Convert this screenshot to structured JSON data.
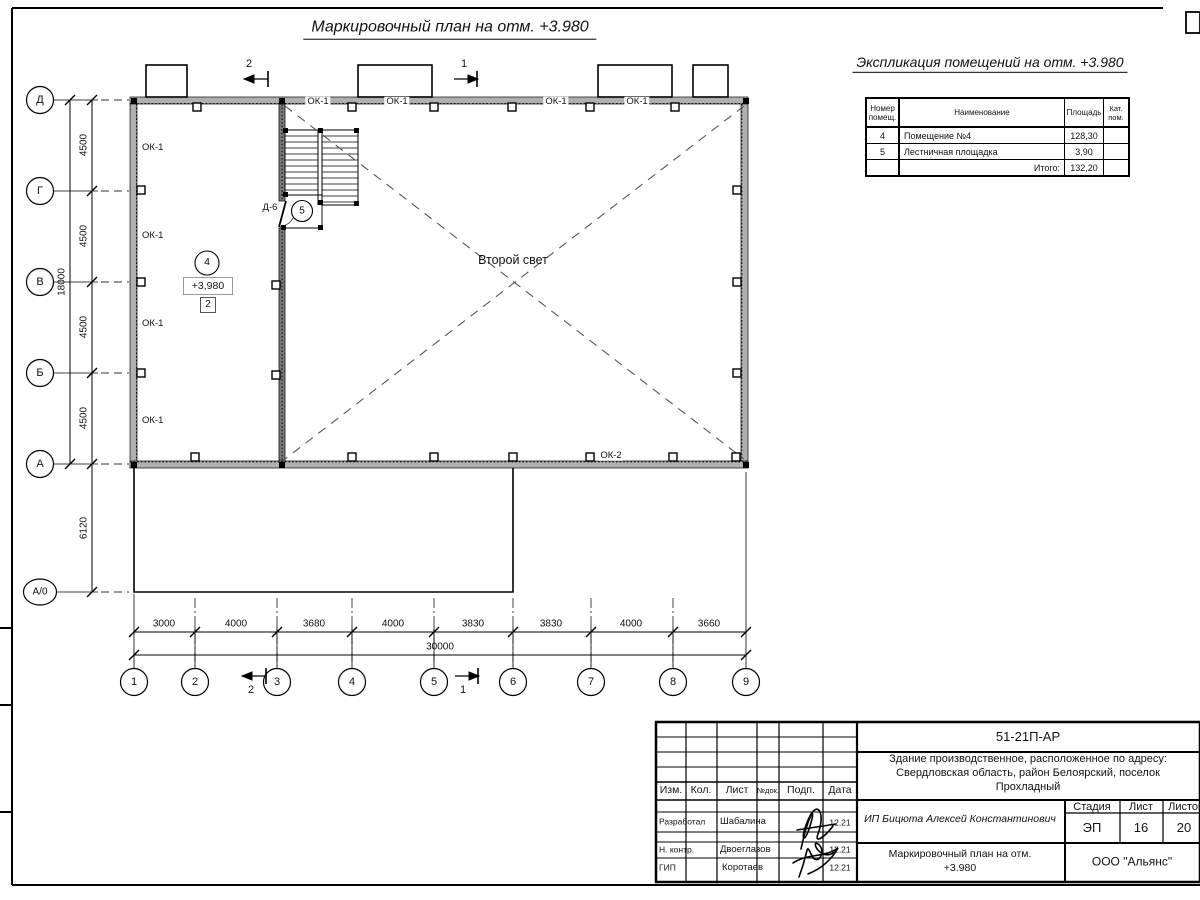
{
  "sheet": {
    "plan_title": "Маркировочный план на отм. +3.980",
    "explication_title": "Экспликация помещений на отм. +3.980"
  },
  "plan": {
    "row_axes": [
      "Д",
      "Г",
      "В",
      "Б",
      "А",
      "А/0"
    ],
    "col_axes": [
      "1",
      "2",
      "3",
      "4",
      "5",
      "6",
      "7",
      "8",
      "9"
    ],
    "v_dims": [
      "4500",
      "4500",
      "4500",
      "4500",
      "6120"
    ],
    "v_total": "18000",
    "h_dims": [
      "3000",
      "4000",
      "3680",
      "4000",
      "3830",
      "3830",
      "4000",
      "3660"
    ],
    "h_total": "30000",
    "labels": {
      "ok1": "ОК-1",
      "ok2": "ОК-2",
      "door": "Д-6",
      "room4": "4",
      "room5": "5",
      "elevation": "+3,980",
      "zone": "2",
      "void": "Второй свет",
      "section1": "1",
      "section2": "2"
    }
  },
  "explication": {
    "headers": [
      "Номер помещ.",
      "Наименование",
      "Площадь",
      "Кат. пом."
    ],
    "rows": [
      {
        "num": "4",
        "name": "Помещение №4",
        "area": "128,30",
        "cat": ""
      },
      {
        "num": "5",
        "name": "Лестничная площадка",
        "area": "3,90",
        "cat": ""
      }
    ],
    "total_label": "Итого:",
    "total_value": "132,20"
  },
  "titleblock": {
    "doc_number": "51-21П-АР",
    "address1": "Здание производственное, расположенное по адресу:",
    "address2": "Свердловская область, район Белоярский, поселок",
    "address3": "Прохладный",
    "client": "ИП Бицюта Алексей Константинович",
    "stage_label": "Стадия",
    "sheet_label": "Лист",
    "sheets_label": "Листов",
    "stage": "ЭП",
    "sheet_no": "16",
    "sheets_total": "20",
    "drawing_title1": "Маркировочный план на отм.",
    "drawing_title2": "+3.980",
    "company": "ООО \"Альянс\"",
    "col_izm": "Изм.",
    "col_kol": "Кол.",
    "col_list": "Лист",
    "col_ndok": "№док.",
    "col_podp": "Подп.",
    "col_data": "Дата",
    "row1_role": "Разработал",
    "row1_name": "Шабалина",
    "row1_date": "12.21",
    "row2_role": "Н. контр.",
    "row2_name": "Двоеглазов",
    "row2_date": "12.21",
    "row3_role": "ГИП",
    "row3_name": "Коротаев",
    "row3_date": "12.21"
  }
}
